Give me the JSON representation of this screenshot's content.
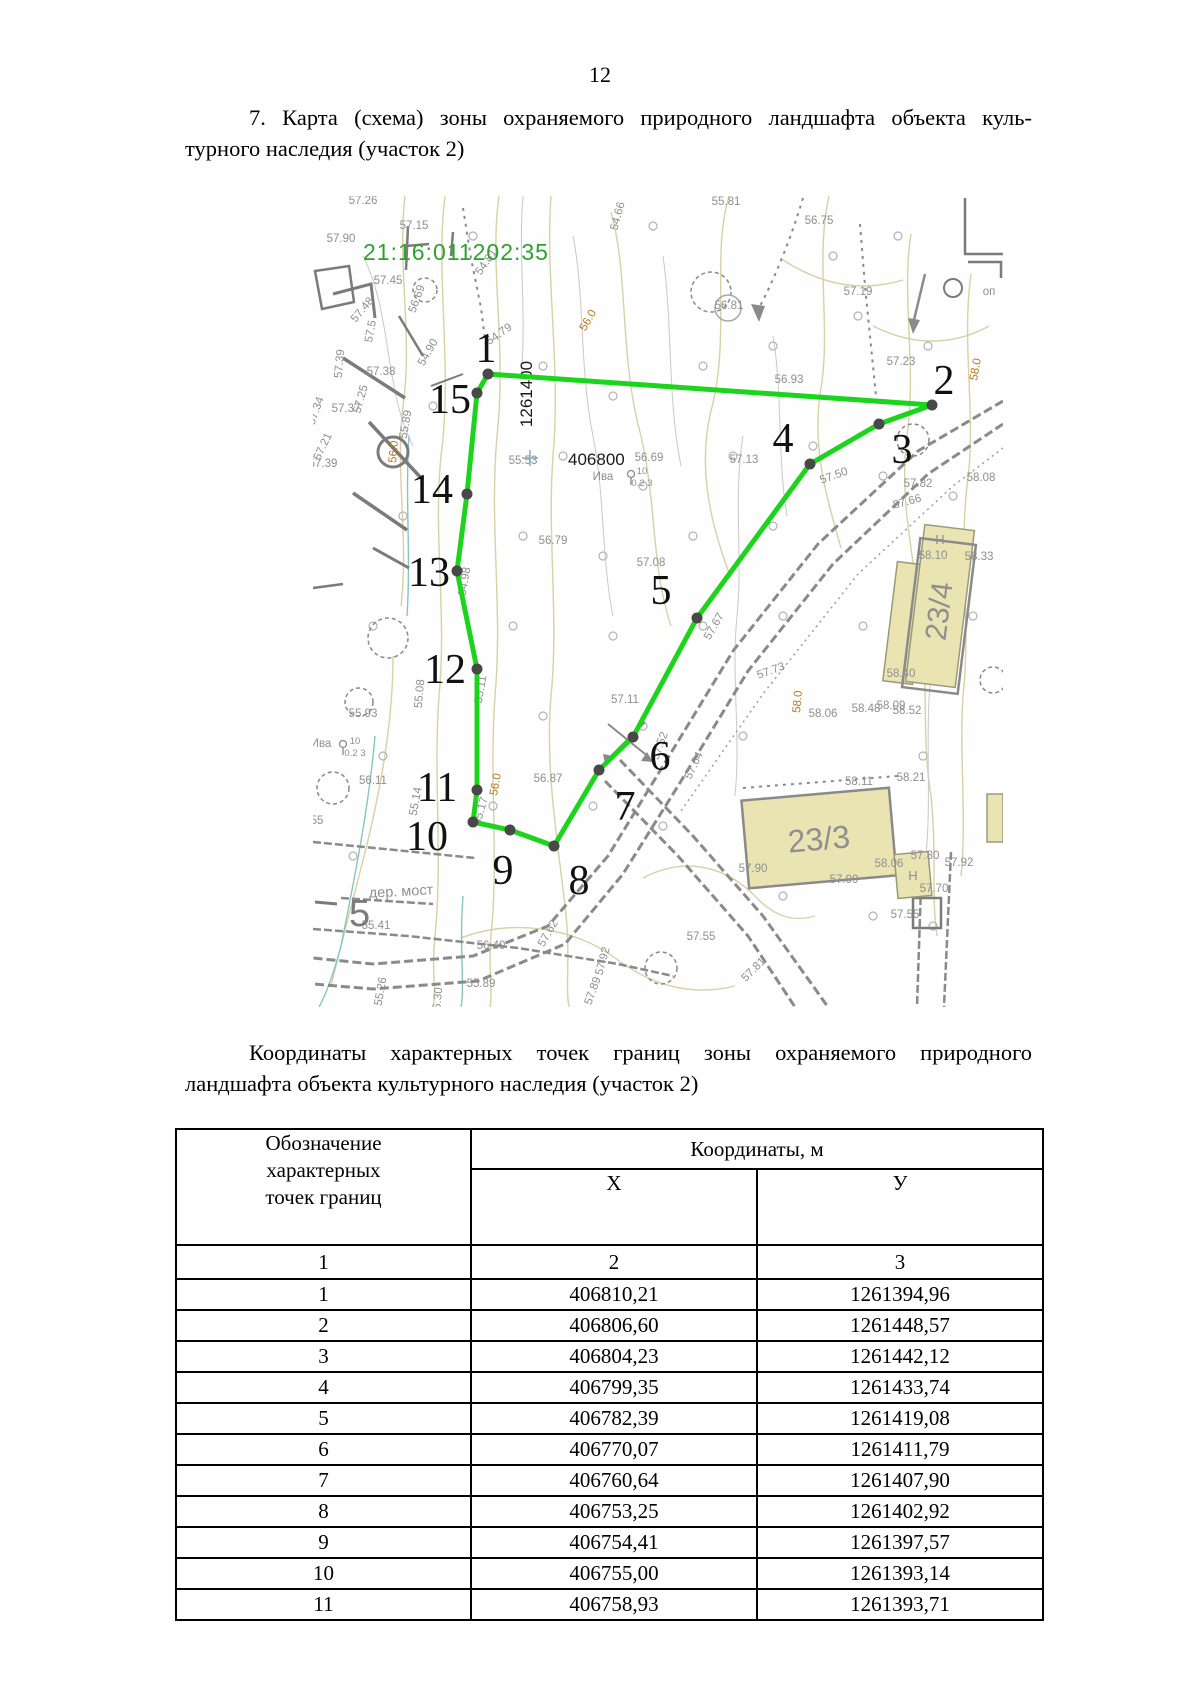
{
  "page": {
    "number": "12"
  },
  "heading": {
    "line1": "7. Карта (схема) зоны охраняемого природного ландшафта объекта куль-",
    "line2": "турного наследия (участок 2)"
  },
  "subheading": {
    "line1": "Координаты характерных точек границ зоны охраняемого природного",
    "line2": "ландшафта объекта культурного наследия (участок 2)"
  },
  "table": {
    "col1_header": "Обозначение\nхарактерных\nточек границ",
    "coords_header": "Координаты, м",
    "x_header": "Х",
    "y_header": "У",
    "index_row": [
      "1",
      "2",
      "3"
    ],
    "rows": [
      [
        "1",
        "406810,21",
        "1261394,96"
      ],
      [
        "2",
        "406806,60",
        "1261448,57"
      ],
      [
        "3",
        "406804,23",
        "1261442,12"
      ],
      [
        "4",
        "406799,35",
        "1261433,74"
      ],
      [
        "5",
        "406782,39",
        "1261419,08"
      ],
      [
        "6",
        "406770,07",
        "1261411,79"
      ],
      [
        "7",
        "406760,64",
        "1261407,90"
      ],
      [
        "8",
        "406753,25",
        "1261402,92"
      ],
      [
        "9",
        "406754,41",
        "1261397,57"
      ],
      [
        "10",
        "406755,00",
        "1261393,14"
      ],
      [
        "11",
        "406758,93",
        "1261393,71"
      ]
    ]
  },
  "map": {
    "cadastral_number": "21:16:011202:35",
    "grid_labels": {
      "x": "406800",
      "y": "1261400"
    },
    "road_label": "дер. мост",
    "big_sign": "5",
    "colors": {
      "polygon_green": "#1dd41d",
      "cadastral_green": "#2ea12e",
      "vertex_dot": "#484848",
      "building_fill": "#e9e4b2",
      "label_gray": "#8f8f8f",
      "label_orange": "#b5791c"
    },
    "buildings": [
      {
        "label": "23/4"
      },
      {
        "label": "23/3"
      }
    ],
    "polygon_points": [
      {
        "n": "1",
        "x": 175,
        "y": 178,
        "lx": 173,
        "ly": 152
      },
      {
        "n": "2",
        "x": 619,
        "y": 209,
        "lx": 631,
        "ly": 184
      },
      {
        "n": "3",
        "x": 566,
        "y": 228,
        "lx": 589,
        "ly": 253
      },
      {
        "n": "4",
        "x": 497,
        "y": 268,
        "lx": 470,
        "ly": 242
      },
      {
        "n": "5",
        "x": 384,
        "y": 422,
        "lx": 348,
        "ly": 394
      },
      {
        "n": "6",
        "x": 320,
        "y": 541,
        "lx": 347,
        "ly": 560
      },
      {
        "n": "7",
        "x": 286,
        "y": 574,
        "lx": 312,
        "ly": 610
      },
      {
        "n": "8",
        "x": 241,
        "y": 650,
        "lx": 266,
        "ly": 684
      },
      {
        "n": "9",
        "x": 197,
        "y": 634,
        "lx": 190,
        "ly": 674
      },
      {
        "n": "10",
        "x": 160,
        "y": 626,
        "lx": 114,
        "ly": 640
      },
      {
        "n": "11",
        "x": 164,
        "y": 594,
        "lx": 124,
        "ly": 591
      },
      {
        "n": "12",
        "x": 164,
        "y": 473,
        "lx": 132,
        "ly": 473
      },
      {
        "n": "13",
        "x": 144,
        "y": 375,
        "lx": 116,
        "ly": 376
      },
      {
        "n": "14",
        "x": 154,
        "y": 298,
        "lx": 119,
        "ly": 293
      },
      {
        "n": "15",
        "x": 164,
        "y": 197,
        "lx": 137,
        "ly": 203
      }
    ],
    "labels": [
      [
        "57.26",
        50,
        8,
        0,
        "g"
      ],
      [
        "57.15",
        101,
        33,
        0,
        "g"
      ],
      [
        "57.90",
        28,
        46,
        0,
        "g"
      ],
      [
        "57.45",
        75,
        88,
        0,
        "g"
      ],
      [
        "56.69",
        107,
        104,
        -70,
        "g"
      ],
      [
        "54.81",
        176,
        68,
        -55,
        "g"
      ],
      [
        "54.66",
        308,
        21,
        -75,
        "g"
      ],
      [
        "54.79",
        188,
        141,
        -35,
        "g"
      ],
      [
        "54.90",
        118,
        158,
        -60,
        "g"
      ],
      [
        "55.81",
        413,
        9,
        0,
        "g"
      ],
      [
        "56.75",
        506,
        28,
        0,
        "g"
      ],
      [
        "57.19",
        545,
        99,
        0,
        "g"
      ],
      [
        "56.81",
        416,
        113,
        0,
        "g"
      ],
      [
        "56.0",
        278,
        126,
        -60,
        "o"
      ],
      [
        "57.23",
        588,
        169,
        0,
        "g"
      ],
      [
        "56.93",
        476,
        187,
        0,
        "g"
      ],
      [
        "58.0",
        666,
        174,
        -80,
        "o"
      ],
      [
        "57.48",
        52,
        116,
        -50,
        "g"
      ],
      [
        "57.5",
        61,
        136,
        -80,
        "g"
      ],
      [
        "57.39",
        30,
        168,
        -85,
        "g"
      ],
      [
        "57.38",
        68,
        179,
        0,
        "g"
      ],
      [
        "57.25",
        51,
        204,
        -75,
        "g"
      ],
      [
        "57.34",
        6,
        216,
        -70,
        "g"
      ],
      [
        "57.21",
        13,
        252,
        -65,
        "g"
      ],
      [
        "57.37",
        33,
        216,
        0,
        "g"
      ],
      [
        "55.89",
        96,
        229,
        -80,
        "g"
      ],
      [
        "56.0",
        84,
        256,
        -85,
        "o"
      ],
      [
        "57.39",
        10,
        271,
        0,
        "g"
      ],
      [
        "55.53",
        210,
        268,
        0,
        "g"
      ],
      [
        "56.69",
        336,
        265,
        0,
        "g"
      ],
      [
        "57.13",
        431,
        267,
        0,
        "g"
      ],
      [
        "Ива",
        290,
        284,
        0,
        "g"
      ],
      [
        "10",
        329,
        278,
        0,
        "g",
        9.5
      ],
      [
        "0.2 3",
        329,
        290,
        0,
        "g",
        9.5
      ],
      [
        "56.79",
        240,
        348,
        0,
        "g"
      ],
      [
        "57.08",
        338,
        370,
        0,
        "g"
      ],
      [
        "57.11",
        312,
        507,
        0,
        "g"
      ],
      [
        "57.67",
        404,
        432,
        -60,
        "g"
      ],
      [
        "57.52",
        350,
        551,
        -70,
        "g"
      ],
      [
        "57.64",
        384,
        571,
        -65,
        "g"
      ],
      [
        "57.73",
        459,
        478,
        -20,
        "g"
      ],
      [
        "58.06",
        510,
        521,
        0,
        "g"
      ],
      [
        "58.09",
        578,
        513,
        0,
        "g"
      ],
      [
        "54.98",
        155,
        386,
        -80,
        "g"
      ],
      [
        "55.11",
        171,
        494,
        -80,
        "g"
      ],
      [
        "55.08",
        110,
        498,
        -85,
        "g"
      ],
      [
        "55.93",
        50,
        521,
        0,
        "g"
      ],
      [
        "Ива",
        8,
        551,
        0,
        "g"
      ],
      [
        "10",
        42,
        548,
        0,
        "g",
        9.5
      ],
      [
        "0.2 3",
        42,
        560,
        0,
        "g",
        9.5
      ],
      [
        "56.11",
        60,
        588,
        0,
        "g"
      ],
      [
        "55",
        4,
        628,
        0,
        "g"
      ],
      [
        "55.14",
        106,
        606,
        -80,
        "g"
      ],
      [
        "55.17",
        171,
        616,
        -75,
        "g"
      ],
      [
        "56.0",
        186,
        589,
        -80,
        "o"
      ],
      [
        "56.87",
        235,
        586,
        0,
        "g"
      ],
      [
        "58.0",
        488,
        506,
        -85,
        "o"
      ],
      [
        "58.48",
        553,
        516,
        0,
        "g"
      ],
      [
        "58.52",
        594,
        518,
        0,
        "g"
      ],
      [
        "58.21",
        598,
        585,
        0,
        "g"
      ],
      [
        "58.11",
        546,
        589,
        0,
        "g"
      ],
      [
        "57.90",
        440,
        676,
        0,
        "g"
      ],
      [
        "57.99",
        531,
        687,
        0,
        "g"
      ],
      [
        "58.06",
        576,
        671,
        0,
        "g"
      ],
      [
        "57.55",
        388,
        744,
        0,
        "g"
      ],
      [
        "57.55",
        592,
        722,
        0,
        "g"
      ],
      [
        "55.41",
        63,
        733,
        0,
        "g"
      ],
      [
        "56.40",
        178,
        753,
        0,
        "g"
      ],
      [
        "55.89",
        168,
        791,
        0,
        "g"
      ],
      [
        "55.26",
        71,
        796,
        -80,
        "g"
      ],
      [
        "55.30",
        128,
        806,
        -85,
        "g"
      ],
      [
        "57.62",
        238,
        739,
        -60,
        "g"
      ],
      [
        "57.92",
        293,
        766,
        -75,
        "g"
      ],
      [
        "57.89",
        283,
        796,
        -70,
        "g"
      ],
      [
        "57.81",
        443,
        776,
        -45,
        "g"
      ],
      [
        "57.70",
        621,
        696,
        0,
        "g"
      ],
      [
        "57.80",
        612,
        663,
        0,
        "g"
      ],
      [
        "57.92",
        646,
        670,
        0,
        "g"
      ],
      [
        "57.50",
        522,
        283,
        -20,
        "g"
      ],
      [
        "57.82",
        605,
        291,
        0,
        "g"
      ],
      [
        "58.08",
        668,
        285,
        0,
        "g"
      ],
      [
        "57.66",
        595,
        309,
        -15,
        "g"
      ],
      [
        "58.10",
        620,
        363,
        0,
        "g"
      ],
      [
        "58.33",
        666,
        364,
        0,
        "g"
      ],
      [
        "58.40",
        588,
        481,
        0,
        "g"
      ],
      [
        "H",
        627,
        348,
        0,
        "g",
        13
      ],
      [
        "H",
        600,
        684,
        0,
        "g",
        13
      ],
      [
        "оп",
        676,
        99,
        0,
        "g"
      ]
    ]
  }
}
